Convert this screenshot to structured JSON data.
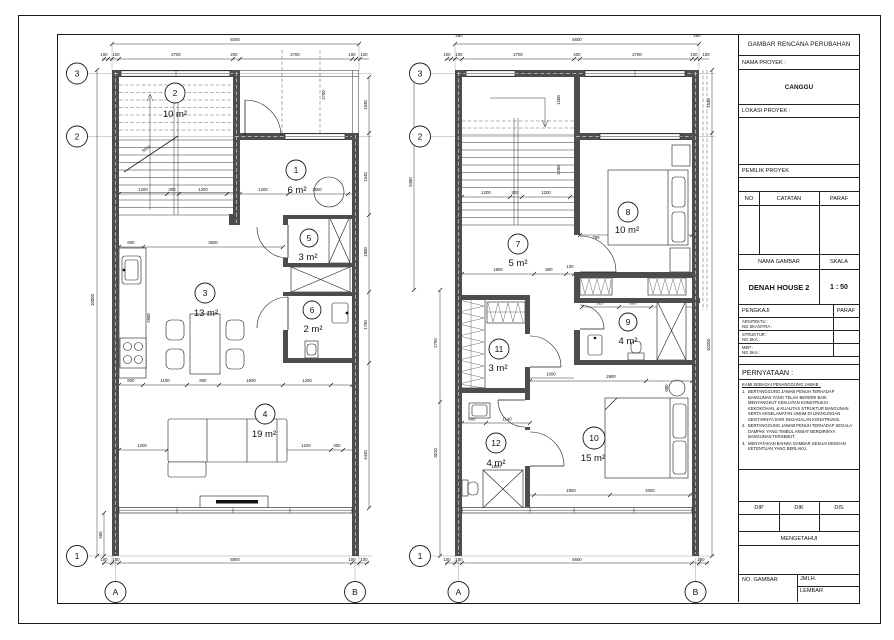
{
  "title_block": {
    "header": "GAMBAR RENCANA PERUBAHAN",
    "nama_proyek_label": "NAMA PROYEK :",
    "nama_proyek_value": "CANGGU",
    "lokasi_proyek_label": "LOKASI PROYEK :",
    "pemilik_proyek_label": "PEMILIK PROYEK",
    "catatan_cols": {
      "no": "NO",
      "catatan": "CATATAN",
      "paraf": "PARAF"
    },
    "nama_gambar_label": "NAMA GAMBAR",
    "skala_label": "SKALA",
    "nama_gambar_value": "DENAH HOUSE 2",
    "skala_value": "1 : 50",
    "pengkaji_label": "PENGKAJI",
    "pengkaji_paraf_label": "PARAF",
    "pengkaji_rows": [
      {
        "l1": "ARSITEKTU :",
        "l2": "NO SKA/STRA :"
      },
      {
        "l1": "STRUKTUR :",
        "l2": "NO SKA :"
      },
      {
        "l1": "MEP :",
        "l2": "NO SKA :"
      }
    ],
    "pernyataan_label": "PERNYATAAN :",
    "pernyataan_sub": "KAMI SEBAGAI PENANGGUNG JAWAB :",
    "pernyataan_nums": [
      "1.",
      "2.",
      "3."
    ],
    "pernyataan_items": [
      "BERTANGGUNG JAWAB PENUH TERHADAP BANGUNAN YANG TELAH BERDIRI BAIK MENYANGKUT KEKUATAN KONSTRUKSI KEKOKOHAN, & KUALITAS STRUKTUR BANGUNAN SERTA KESELAMATAN UMUM DI LINGKUNGAN SEKITARNYA DARI KEGAGALAN KONSTRUKSI.",
      "BERTANGGUNG JAWAB PENUH TERHADAP SEGALA DAMPAK YANG TIMBUL AKIBAT BERDIRINYA BANGUNAN TERSEBUT.",
      "MENYATAKAN BAHWA GAMBAR SESUAI DENGAN KETENTUAN YANG BERLAKU."
    ],
    "sign_cols": [
      "DIP",
      "DIK",
      "DIS"
    ],
    "mengetahui_label": "MENGETAHUI",
    "no_gambar_label": "NO. GAMBAR",
    "jmlh_label": "JMLH.",
    "lembar_label": "LEMBAR"
  },
  "plans": {
    "left": {
      "grid": {
        "g1": "1",
        "g2": "2",
        "g3": "3",
        "ga": "A",
        "gb": "B"
      },
      "rooms": {
        "r1": {
          "no": "1",
          "area": "6 m²"
        },
        "r2": {
          "no": "2",
          "area": "10 m²"
        },
        "r3": {
          "no": "3",
          "area": "13 m²"
        },
        "r4": {
          "no": "4",
          "area": "19 m²"
        },
        "r5": {
          "no": "5",
          "area": "3 m²"
        },
        "r6": {
          "no": "6",
          "area": "2 m²"
        }
      },
      "dims": {
        "w6000": "6000",
        "t100a": "100",
        "t100b": "100",
        "t2700a": "2700",
        "t200": "200",
        "t2700b": "2700",
        "t100c": "100",
        "t100d": "100",
        "b100a": "100",
        "b100b": "100",
        "b5800": "5800",
        "b100c": "100",
        "b100d": "100",
        "h10000": "10000",
        "h950": "950",
        "s1200a": "1200",
        "s300": "300",
        "s1200b": "1200",
        "s3450": "3450",
        "r1_1200": "1200",
        "r1_1500": "1500",
        "porch2700": "2700",
        "k600": "600",
        "k3500": "3500",
        "f600": "600",
        "f1100": "1100",
        "f800": "800",
        "f1600": "1600",
        "f1200": "1200",
        "v2600": "2600",
        "v1400": "1400",
        "l1200": "1200",
        "l2880": "2880",
        "l1220": "1220",
        "l300": "300",
        "e1630": "1630",
        "e1640": "1640",
        "e1800": "1800",
        "e1790": "1790",
        "e4440": "4440"
      }
    },
    "right": {
      "grid": {
        "g1": "1",
        "g2": "2",
        "g3": "3",
        "ga": "A",
        "gb": "B"
      },
      "rooms": {
        "r7": {
          "no": "7",
          "area": "5 m²"
        },
        "r8": {
          "no": "8",
          "area": "10 m²"
        },
        "r9": {
          "no": "9",
          "area": "4 m²"
        },
        "r10": {
          "no": "10",
          "area": "15 m²"
        },
        "r11": {
          "no": "11",
          "area": "3 m²"
        },
        "r12": {
          "no": "12",
          "area": "4 m²"
        }
      },
      "dims": {
        "w5600": "5600",
        "t100a": "100",
        "t100b": "100",
        "t2700a": "2700",
        "t200": "200",
        "t2700b": "2700",
        "t100c": "100",
        "t100d": "100",
        "t280a": "280",
        "t280b": "280",
        "b100a": "100",
        "b100b": "100",
        "b5600": "5600",
        "b280": "280",
        "s1200a": "1200",
        "s300": "300",
        "s1200b": "1200",
        "s2280": "2280",
        "s1200v": "1200",
        "h7_1800": "1800",
        "h7_800": "800",
        "h7_100": "100",
        "r8_790": "790",
        "r8_2000": "2000",
        "r8_750": "750",
        "r8_1850": "1850",
        "r9_920": "920",
        "r9_800": "800",
        "r9_1070": "1070",
        "r9_1600": "1600",
        "r10_2900": "2900",
        "r10_1900": "1900",
        "r10_2000": "2000",
        "r10_600": "600",
        "r11_1000": "1000",
        "r12_600": "600",
        "r12_1140": "1140",
        "r12_1600": "1600",
        "r12_1000": "1000",
        "e5480": "5480",
        "e2790": "2790",
        "e3010": "3010",
        "e1630": "1630",
        "e10200": "10200"
      }
    }
  }
}
